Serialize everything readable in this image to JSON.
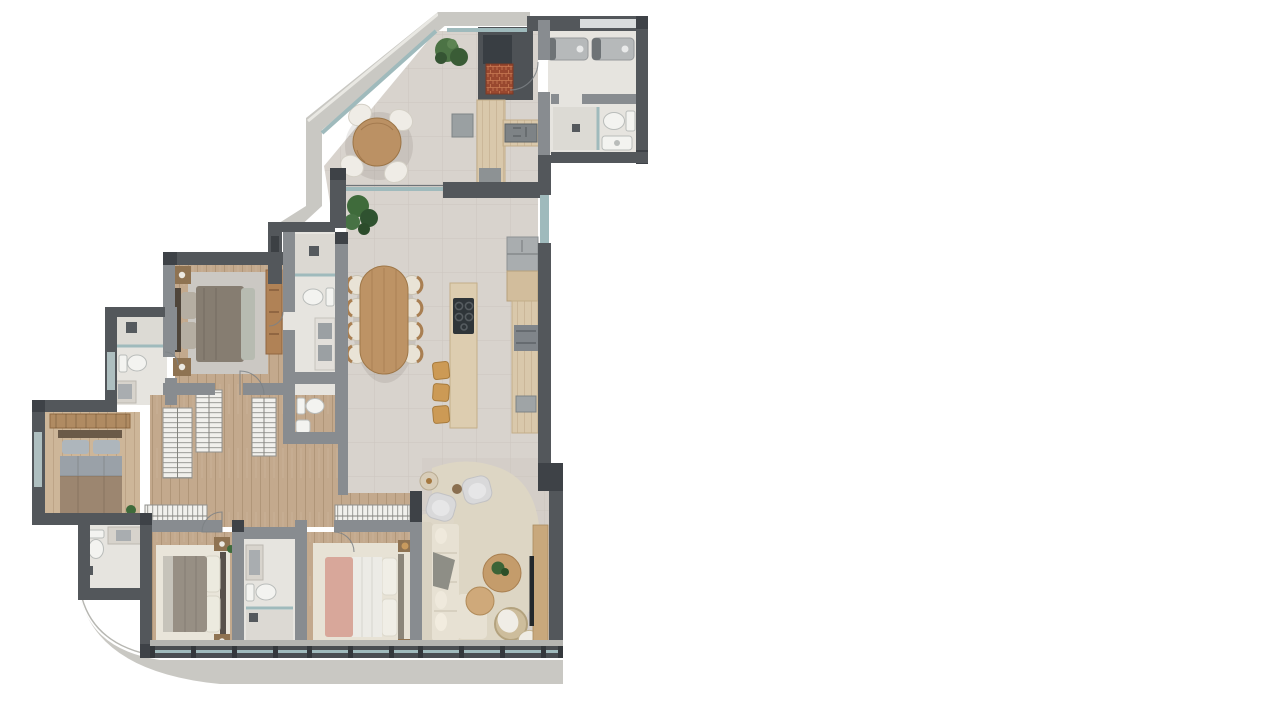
{
  "meta": {
    "description": "Photorealistic top-down rendered floor plan of a large apartment, placed on a plain white background occupying the left half of the canvas",
    "visible_text": "none",
    "orientation": "top-down"
  },
  "palette": {
    "background": "#ffffff",
    "wall_dark": "#53575b",
    "wall_medium": "#888c90",
    "column_dark": "#3e4247",
    "concrete_band": "#c9c8c3",
    "tile_floor": "#d8d3cd",
    "tile_floor_warm": "#d4cec8",
    "wood_floor": "#c3a98d",
    "wood_floor_light": "#cdb699",
    "bath_floor": "#e6e4df",
    "glass": "#9fbabc",
    "counter_wood": "#d9c8ab",
    "dining_table_wood": "#bd9365",
    "sofa_cream": "#e7e1d3",
    "rug_beige": "#ddd6c4",
    "plant_green": "#3f6b3b",
    "grill_brick": "#99482f",
    "stool_tan": "#cc9a55",
    "bed_pink": "#d8a79a",
    "appliance_gray": "#b6b9ba"
  },
  "rooms": {
    "terrace": {
      "label": "Terrace with round wooden table, four chairs, plants and grill counter"
    },
    "laundry": {
      "label": "Laundry room with washer and dryer"
    },
    "service_bath": {
      "label": "Service bathroom with shower, toilet and sink"
    },
    "kitchen": {
      "label": "Open kitchen with cooktop island, three stools, fridge and counters"
    },
    "dining": {
      "label": "Dining area with oval table and eight chairs"
    },
    "living": {
      "label": "Living room with L-sofa, two armchairs, round coffee tables, rattan chair, TV console and organic rug"
    },
    "master_suite": {
      "label": "Master bedroom with double bed, nightstands and dresser"
    },
    "master_bath": {
      "label": "Master bathroom with shower, toilet and double sink"
    },
    "powder_room": {
      "label": "Powder room with toilet and sink"
    },
    "hall_bath": {
      "label": "Hall bathroom with shower, toilet and sink"
    },
    "corridor": {
      "label": "Corridor with hatched wardrobe closets"
    },
    "guest_bedroom": {
      "label": "Guest bedroom (left wing) with double bed and closet rod"
    },
    "guest_bath": {
      "label": "Guest bathroom with toilet and sink counter"
    },
    "bedroom_2": {
      "label": "Bedroom with bed on cream rug and side tables"
    },
    "ensuite_bath": {
      "label": "En-suite bathroom with sink counter, toilet and shower"
    },
    "bedroom_3": {
      "label": "Bedroom with white-and-pink bed, rug and wardrobe"
    }
  },
  "summary": {
    "bedrooms": 4,
    "bathrooms": 6,
    "text_labels": "none",
    "legend": "none"
  }
}
